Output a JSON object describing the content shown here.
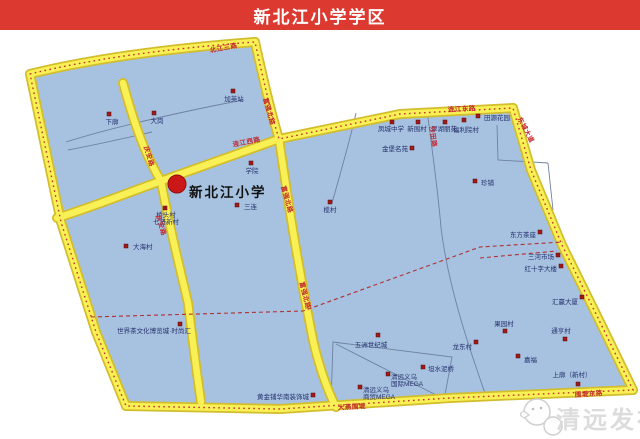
{
  "header": {
    "title": "新北江小学学区"
  },
  "map": {
    "school": {
      "name": "新北江小学",
      "x": 177,
      "y": 184
    },
    "colors": {
      "header_bg": "#dc3a31",
      "district_fill": "#a6c2e0",
      "road_fill": "#f9f056",
      "road_casing": "#d2bd2c",
      "boundary_dash": "#c23030",
      "split_dash": "#b03030",
      "poi_dot": "#a01818",
      "poi_text": "#26306b",
      "road_text": "#c2272d",
      "stream": "#6e82a0",
      "watermark": "#d9d9d9"
    },
    "pois": [
      {
        "t": "下廓",
        "dx": 109,
        "dy": 114,
        "lx": 112,
        "ly": 124,
        "a": "m"
      },
      {
        "t": "大岗",
        "dx": 154,
        "dy": 113,
        "lx": 157,
        "ly": 123,
        "a": "m"
      },
      {
        "t": "加英站",
        "dx": 233,
        "dy": 91,
        "lx": 234,
        "ly": 101,
        "a": "m"
      },
      {
        "t": "学院",
        "dx": 251,
        "dy": 163,
        "lx": 252,
        "ly": 173,
        "a": "m"
      },
      {
        "t": "三连",
        "dx": 237,
        "dy": 205,
        "lx": 244,
        "ly": 209,
        "a": "s"
      },
      {
        "t": "榄村",
        "dx": 330,
        "dy": 202,
        "lx": 330,
        "ly": 212,
        "a": "m"
      },
      {
        "t": "桥头村",
        "lines": [
          "桥头村",
          "七贤新村"
        ],
        "dx": 165,
        "dy": 208,
        "lx": 166,
        "ly": 217,
        "a": "m"
      },
      {
        "t": "大海村",
        "dx": 126,
        "dy": 246,
        "lx": 133,
        "ly": 249,
        "a": "s"
      },
      {
        "t": "凤城中学",
        "dx": 392,
        "dy": 122,
        "lx": 391,
        "ly": 131,
        "a": "m"
      },
      {
        "t": "新围村",
        "dx": 418,
        "dy": 122,
        "lx": 417,
        "ly": 131,
        "a": "m"
      },
      {
        "t": "翠湖丽苑",
        "dx": 445,
        "dy": 122,
        "lx": 444,
        "ly": 131,
        "a": "m"
      },
      {
        "t": "福利院村",
        "dx": 464,
        "dy": 120,
        "lx": 466,
        "ly": 132,
        "a": "m"
      },
      {
        "t": "田源花园",
        "dx": 478,
        "dy": 116,
        "lx": 484,
        "ly": 120,
        "a": "s"
      },
      {
        "t": "金堡名苑",
        "dx": 412,
        "dy": 148,
        "lx": 408,
        "ly": 151,
        "a": "e"
      },
      {
        "t": "珍铺",
        "dx": 475,
        "dy": 181,
        "lx": 481,
        "ly": 185,
        "a": "s"
      },
      {
        "t": "东方茶座",
        "dx": 540,
        "dy": 232,
        "lx": 536,
        "ly": 237,
        "a": "e"
      },
      {
        "t": "三河市场",
        "dx": 558,
        "dy": 255,
        "lx": 554,
        "ly": 259,
        "a": "e"
      },
      {
        "t": "红十字大楼",
        "dx": 561,
        "dy": 266,
        "lx": 557,
        "ly": 271,
        "a": "e"
      },
      {
        "t": "汇赢大厦",
        "dx": 582,
        "dy": 297,
        "lx": 578,
        "ly": 304,
        "a": "e"
      },
      {
        "t": "果园村",
        "dx": 505,
        "dy": 331,
        "lx": 504,
        "ly": 326,
        "a": "m"
      },
      {
        "t": "通亨村",
        "dx": 565,
        "dy": 339,
        "lx": 561,
        "ly": 333,
        "a": "m"
      },
      {
        "t": "龙东村",
        "dx": 476,
        "dy": 342,
        "lx": 472,
        "ly": 349,
        "a": "e"
      },
      {
        "t": "嘉福",
        "dx": 518,
        "dy": 356,
        "lx": 524,
        "ly": 362,
        "a": "s"
      },
      {
        "t": "上廓（新村）",
        "dx": 578,
        "dy": 384,
        "lx": 572,
        "ly": 377,
        "a": "m"
      },
      {
        "t": "五洲世纪城",
        "dx": 378,
        "dy": 335,
        "lx": 371,
        "ly": 347,
        "a": "m"
      },
      {
        "t": "坦水泥桥",
        "dx": 423,
        "dy": 367,
        "lx": 428,
        "ly": 371,
        "a": "s"
      },
      {
        "t": "清远义乌",
        "lines": [
          "清远义乌",
          "国际MEGA"
        ],
        "dx": 388,
        "dy": 374,
        "lx": 391,
        "ly": 379,
        "a": "s"
      },
      {
        "t": "清远义乌",
        "lines": [
          "清远义乌",
          "商贸MEGA"
        ],
        "dx": 360,
        "dy": 387,
        "lx": 363,
        "ly": 392,
        "a": "s"
      },
      {
        "t": "黄金铺华南装饰城",
        "dx": 313,
        "dy": 395,
        "lx": 309,
        "ly": 399,
        "a": "e"
      },
      {
        "t": "世界茶文化博览城·时尚汇",
        "dx": 180,
        "dy": 324,
        "lx": 154,
        "ly": 333,
        "a": "m"
      }
    ],
    "road_labels": [
      {
        "t": "北江三路",
        "x": 224,
        "y": 50,
        "r": -11
      },
      {
        "t": "庆安路",
        "x": 147,
        "y": 157,
        "r": 73
      },
      {
        "t": "庆安路",
        "x": 159,
        "y": 226,
        "r": 73
      },
      {
        "t": "富强北路",
        "x": 267,
        "y": 112,
        "r": 74
      },
      {
        "t": "富强北路",
        "x": 285,
        "y": 200,
        "r": 74
      },
      {
        "t": "富强北路",
        "x": 303,
        "y": 296,
        "r": 76
      },
      {
        "t": "连江西路",
        "x": 247,
        "y": 144,
        "r": -11
      },
      {
        "t": "连江东路",
        "x": 462,
        "y": 111,
        "r": -3
      },
      {
        "t": "东城大道",
        "x": 524,
        "y": 131,
        "r": 62
      },
      {
        "t": "沙田路",
        "x": 431,
        "y": 137,
        "r": 82
      },
      {
        "t": "大燕围堤",
        "x": 352,
        "y": 409,
        "r": -3
      },
      {
        "t": "围堤东路",
        "x": 589,
        "y": 396,
        "r": -4
      }
    ],
    "watermark": {
      "text": "清远发布"
    }
  }
}
